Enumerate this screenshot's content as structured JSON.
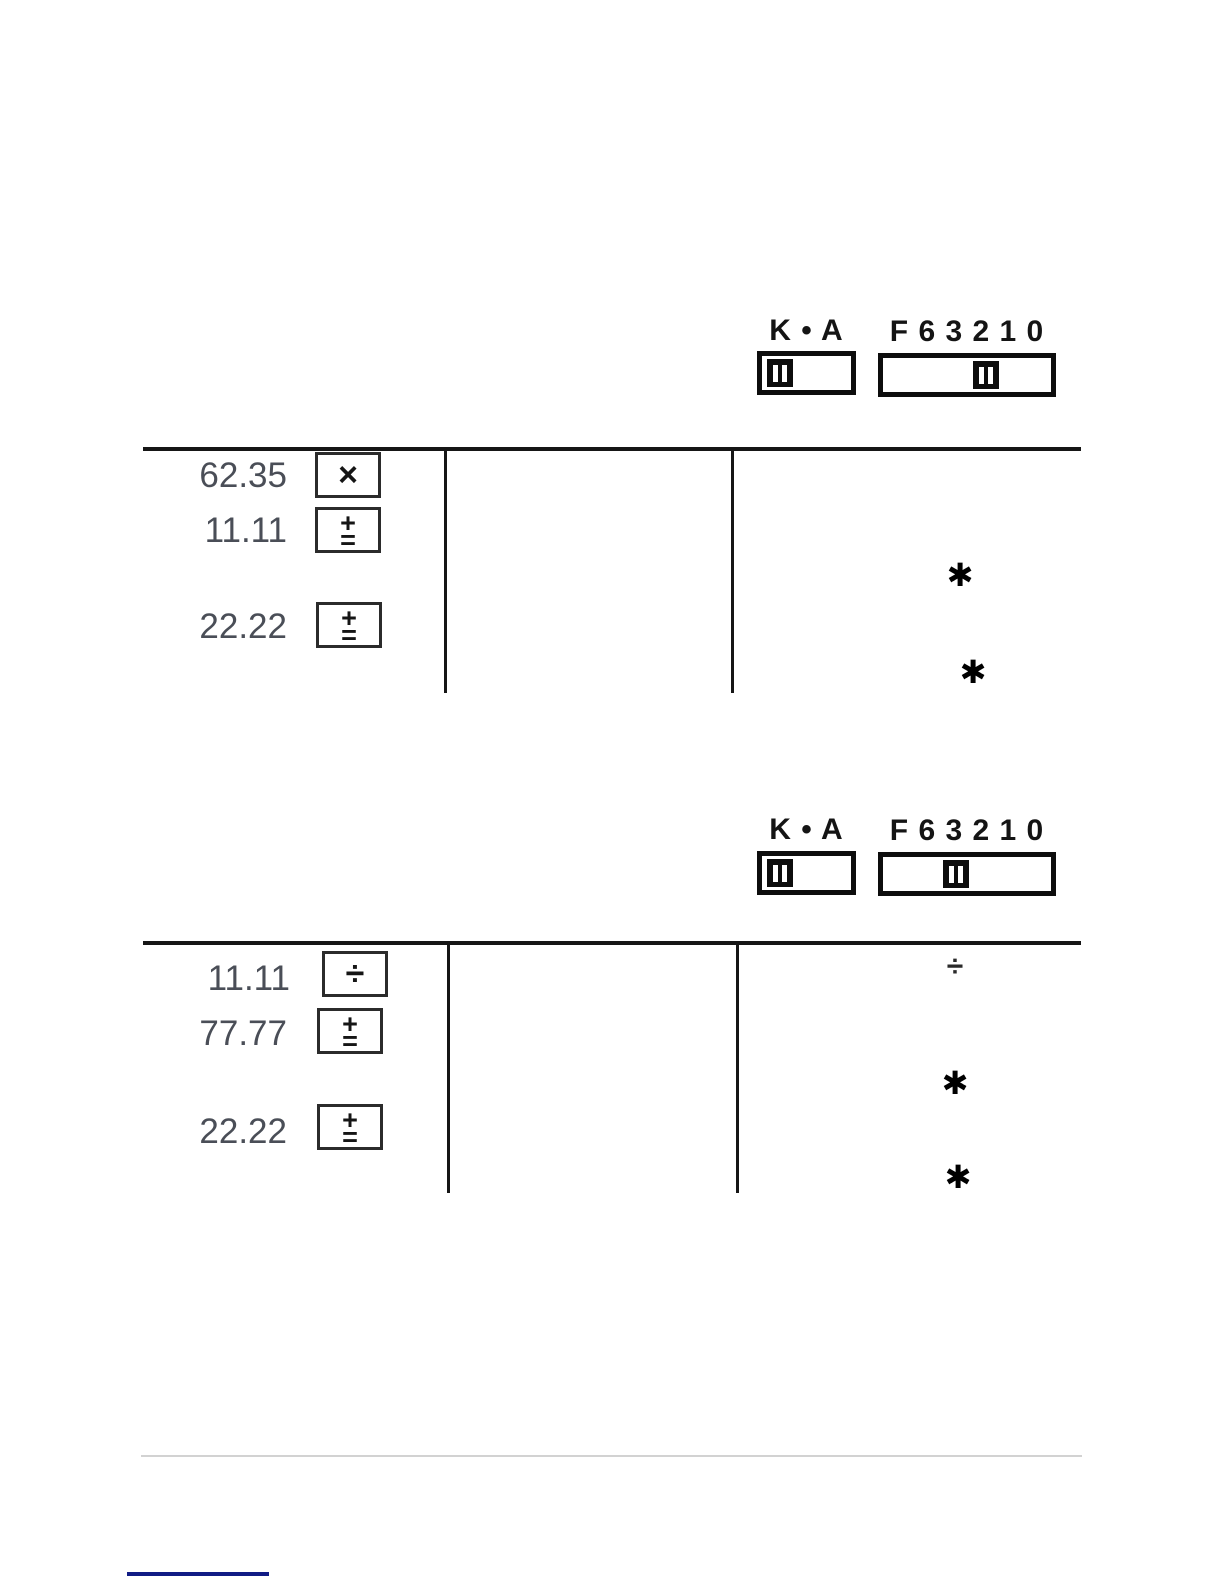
{
  "sections": [
    {
      "name": "constant-multiplication-example",
      "switches": {
        "ka": {
          "label": "K • A",
          "position": "K"
        },
        "decimal": {
          "label": "F 6 3 2 1 0",
          "position": "2"
        }
      },
      "rows": [
        {
          "value": "62.35",
          "key": "×"
        },
        {
          "value": "11.11",
          "key_top": "+",
          "key_bottom": "="
        },
        {
          "value": "22.22",
          "key_top": "+",
          "key_bottom": "="
        }
      ],
      "printout": {
        "marks": [
          "✱",
          "✱"
        ]
      }
    },
    {
      "name": "constant-division-example",
      "switches": {
        "ka": {
          "label": "K • A",
          "position": "K"
        },
        "decimal": {
          "label": "F 6 3 2 1 0",
          "position": "3"
        }
      },
      "rows": [
        {
          "value": "11.11",
          "key": "÷"
        },
        {
          "value": "77.77",
          "key_top": "+",
          "key_bottom": "="
        },
        {
          "value": "22.22",
          "key_top": "+",
          "key_bottom": "="
        }
      ],
      "printout": {
        "operator": "÷",
        "marks": [
          "✱",
          "✱"
        ]
      }
    }
  ],
  "colors": {
    "table_rule": "#161616",
    "entry_number": "#4a4e57",
    "footer_divider": "#d2d2d2",
    "footer_link": "#111c85"
  }
}
